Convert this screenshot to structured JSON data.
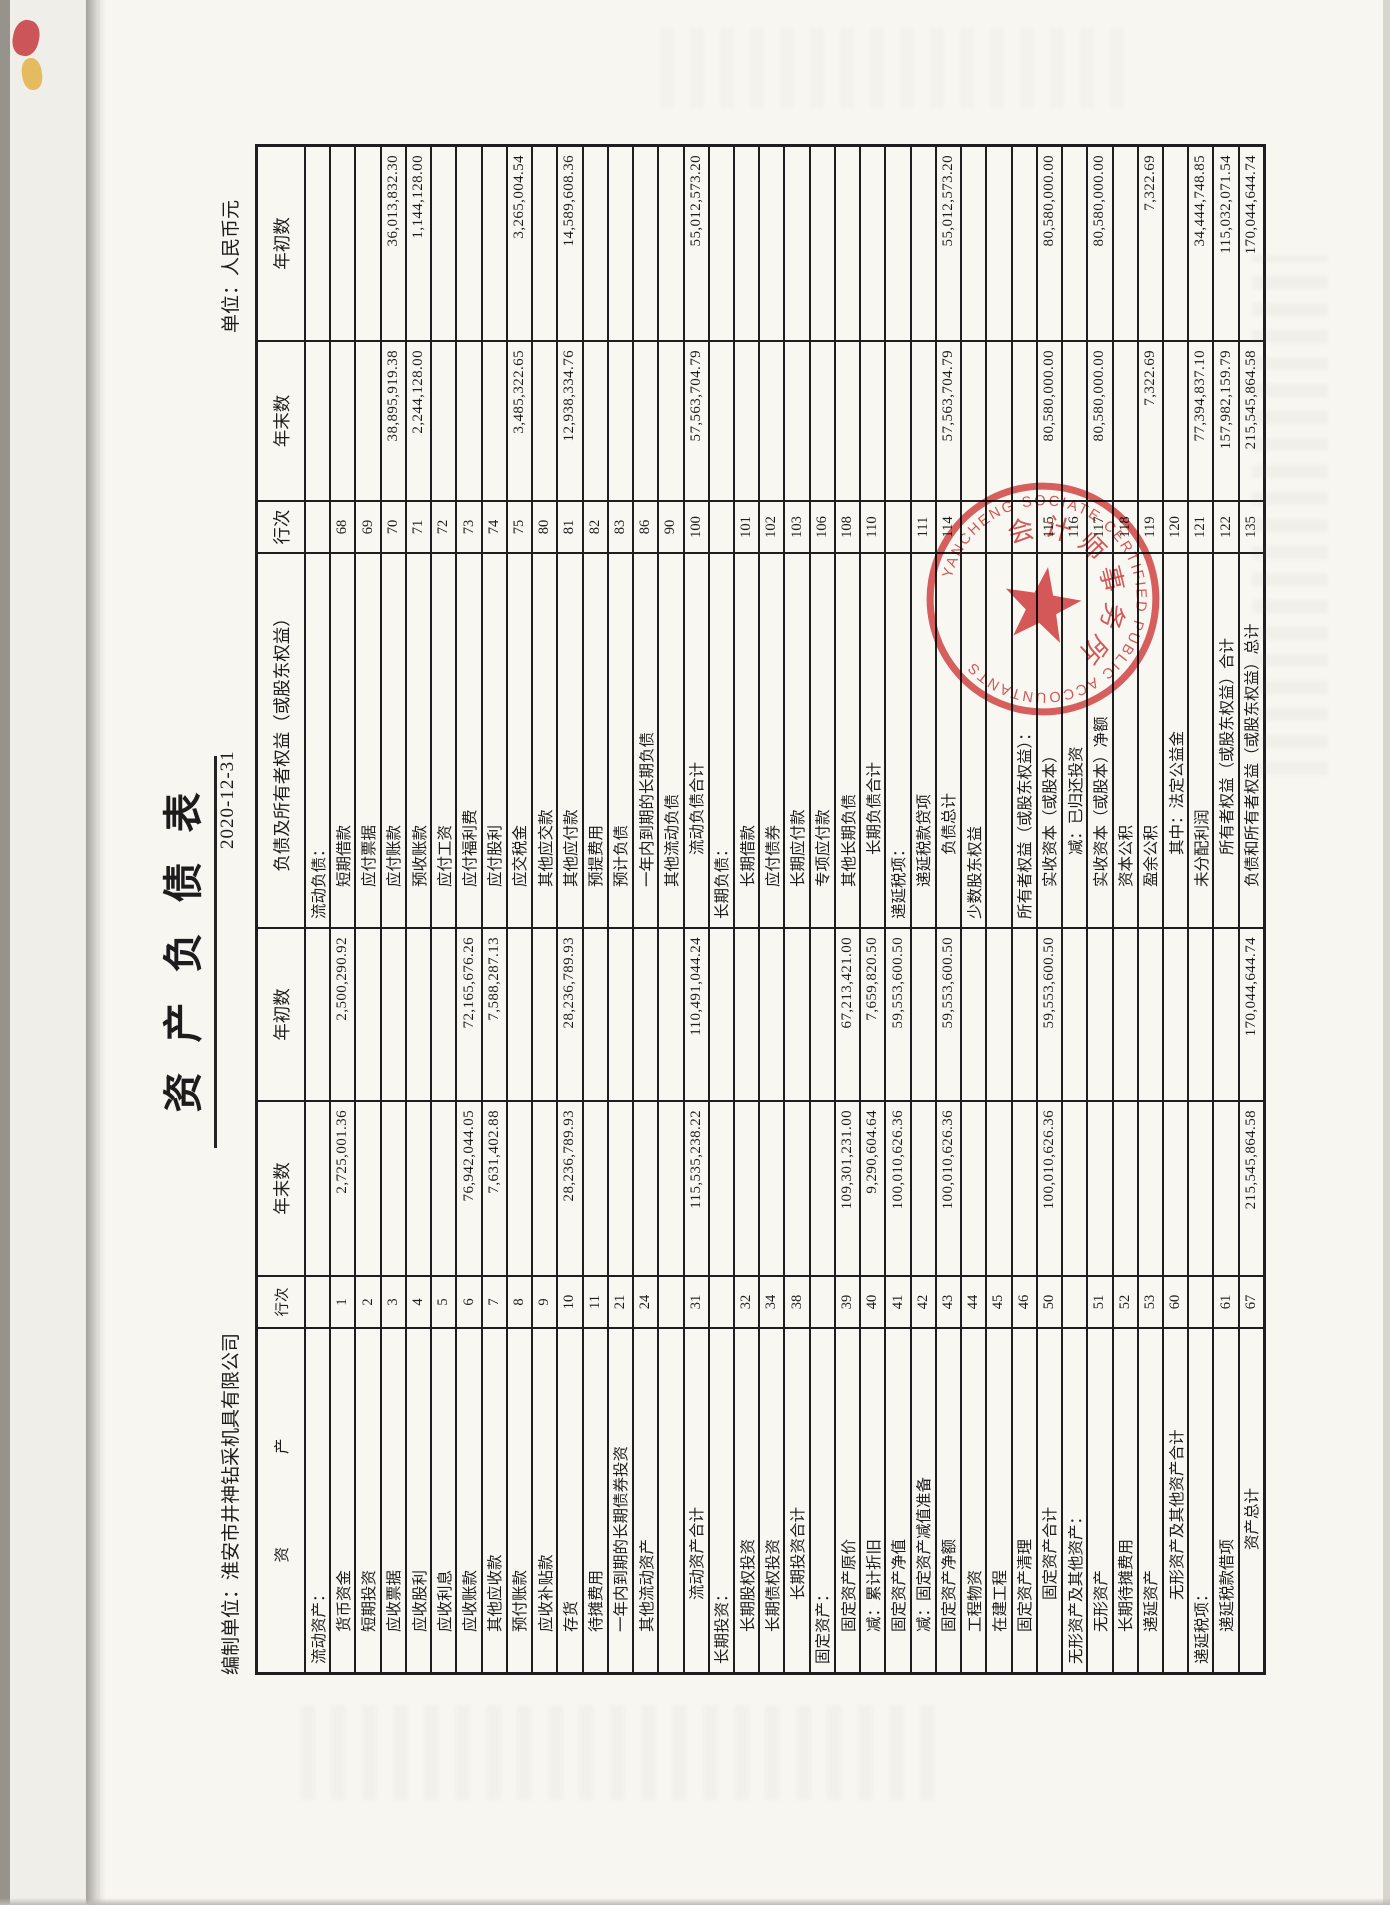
{
  "meta": {
    "title": "资产负债表",
    "prepared_by_label": "编制单位：",
    "company": "淮安市井神钻采机具有限公司",
    "date": "2020-12-31",
    "unit": "单位：人民币元"
  },
  "table": {
    "headers": {
      "asset": "资　　　　　　产",
      "line_no": "行次",
      "year_end": "年末数",
      "year_begin": "年初数",
      "liability": "负债及所有者权益（或股东权益）"
    },
    "rows": [
      {
        "a": "流动资产：",
        "ai": 0,
        "an": "",
        "ae": "",
        "ab": "",
        "l": "流动负债：",
        "li": 0,
        "ln": "",
        "le": "",
        "lb": ""
      },
      {
        "a": "货币资金",
        "ai": 1,
        "an": "1",
        "ae": "2,725,001.36",
        "ab": "2,500,290.92",
        "l": "短期借款",
        "li": 1,
        "ln": "68",
        "le": "",
        "lb": ""
      },
      {
        "a": "短期投资",
        "ai": 1,
        "an": "2",
        "ae": "",
        "ab": "",
        "l": "应付票据",
        "li": 1,
        "ln": "69",
        "le": "",
        "lb": ""
      },
      {
        "a": "应收票据",
        "ai": 1,
        "an": "3",
        "ae": "",
        "ab": "",
        "l": "应付账款",
        "li": 1,
        "ln": "70",
        "le": "38,895,919.38",
        "lb": "36,013,832.30"
      },
      {
        "a": "应收股利",
        "ai": 1,
        "an": "4",
        "ae": "",
        "ab": "",
        "l": "预收账款",
        "li": 1,
        "ln": "71",
        "le": "2,244,128.00",
        "lb": "1,144,128.00"
      },
      {
        "a": "应收利息",
        "ai": 1,
        "an": "5",
        "ae": "",
        "ab": "",
        "l": "应付工资",
        "li": 1,
        "ln": "72",
        "le": "",
        "lb": ""
      },
      {
        "a": "应收账款",
        "ai": 1,
        "an": "6",
        "ae": "76,942,044.05",
        "ab": "72,165,676.26",
        "l": "应付福利费",
        "li": 1,
        "ln": "73",
        "le": "",
        "lb": ""
      },
      {
        "a": "其他应收款",
        "ai": 1,
        "an": "7",
        "ae": "7,631,402.88",
        "ab": "7,588,287.13",
        "l": "应付股利",
        "li": 1,
        "ln": "74",
        "le": "",
        "lb": ""
      },
      {
        "a": "预付账款",
        "ai": 1,
        "an": "8",
        "ae": "",
        "ab": "",
        "l": "应交税金",
        "li": 1,
        "ln": "75",
        "le": "3,485,322.65",
        "lb": "3,265,004.54"
      },
      {
        "a": "应收补贴款",
        "ai": 1,
        "an": "9",
        "ae": "",
        "ab": "",
        "l": "其他应交款",
        "li": 1,
        "ln": "80",
        "le": "",
        "lb": ""
      },
      {
        "a": "存货",
        "ai": 1,
        "an": "10",
        "ae": "28,236,789.93",
        "ab": "28,236,789.93",
        "l": "其他应付款",
        "li": 1,
        "ln": "81",
        "le": "12,938,334.76",
        "lb": "14,589,608.36"
      },
      {
        "a": "待摊费用",
        "ai": 1,
        "an": "11",
        "ae": "",
        "ab": "",
        "l": "预提费用",
        "li": 1,
        "ln": "82",
        "le": "",
        "lb": ""
      },
      {
        "a": "一年内到期的长期债券投资",
        "ai": 1,
        "an": "21",
        "ae": "",
        "ab": "",
        "l": "预计负债",
        "li": 1,
        "ln": "83",
        "le": "",
        "lb": ""
      },
      {
        "a": "其他流动资产",
        "ai": 1,
        "an": "24",
        "ae": "",
        "ab": "",
        "l": "一年内到期的长期负债",
        "li": 1,
        "ln": "86",
        "le": "",
        "lb": ""
      },
      {
        "a": "",
        "ai": 1,
        "an": "",
        "ae": "",
        "ab": "",
        "l": "其他流动负债",
        "li": 1,
        "ln": "90",
        "le": "",
        "lb": ""
      },
      {
        "a": "流动资产合计",
        "ai": 2,
        "an": "31",
        "ae": "115,535,238.22",
        "ab": "110,491,044.24",
        "l": "流动负债合计",
        "li": 2,
        "ln": "100",
        "le": "57,563,704.79",
        "lb": "55,012,573.20"
      },
      {
        "a": "长期投资：",
        "ai": 0,
        "an": "",
        "ae": "",
        "ab": "",
        "l": "长期负债：",
        "li": 0,
        "ln": "",
        "le": "",
        "lb": ""
      },
      {
        "a": "长期股权投资",
        "ai": 1,
        "an": "32",
        "ae": "",
        "ab": "",
        "l": "长期借款",
        "li": 1,
        "ln": "101",
        "le": "",
        "lb": ""
      },
      {
        "a": "长期债权投资",
        "ai": 1,
        "an": "34",
        "ae": "",
        "ab": "",
        "l": "应付债券",
        "li": 1,
        "ln": "102",
        "le": "",
        "lb": ""
      },
      {
        "a": "长期投资合计",
        "ai": 2,
        "an": "38",
        "ae": "",
        "ab": "",
        "l": "长期应付款",
        "li": 1,
        "ln": "103",
        "le": "",
        "lb": ""
      },
      {
        "a": "固定资产：",
        "ai": 0,
        "an": "",
        "ae": "",
        "ab": "",
        "l": "专项应付款",
        "li": 1,
        "ln": "106",
        "le": "",
        "lb": ""
      },
      {
        "a": "固定资产原价",
        "ai": 1,
        "an": "39",
        "ae": "109,301,231.00",
        "ab": "67,213,421.00",
        "l": "其他长期负债",
        "li": 1,
        "ln": "108",
        "le": "",
        "lb": ""
      },
      {
        "a": "减：累计折旧",
        "ai": 1,
        "an": "40",
        "ae": "9,290,604.64",
        "ab": "7,659,820.50",
        "l": "长期负债合计",
        "li": 2,
        "ln": "110",
        "le": "",
        "lb": ""
      },
      {
        "a": "固定资产净值",
        "ai": 1,
        "an": "41",
        "ae": "100,010,626.36",
        "ab": "59,553,600.50",
        "l": "递延税项：",
        "li": 0,
        "ln": "",
        "le": "",
        "lb": ""
      },
      {
        "a": "减：固定资产减值准备",
        "ai": 1,
        "an": "42",
        "ae": "",
        "ab": "",
        "l": "递延税款贷项",
        "li": 1,
        "ln": "111",
        "le": "",
        "lb": ""
      },
      {
        "a": "固定资产净额",
        "ai": 1,
        "an": "43",
        "ae": "100,010,626.36",
        "ab": "59,553,600.50",
        "l": "负债总计",
        "li": 2,
        "ln": "114",
        "le": "57,563,704.79",
        "lb": "55,012,573.20"
      },
      {
        "a": "工程物资",
        "ai": 1,
        "an": "44",
        "ae": "",
        "ab": "",
        "l": "少数股东权益",
        "li": 0,
        "ln": "",
        "le": "",
        "lb": ""
      },
      {
        "a": "在建工程",
        "ai": 1,
        "an": "45",
        "ae": "",
        "ab": "",
        "l": "",
        "li": 1,
        "ln": "",
        "le": "",
        "lb": ""
      },
      {
        "a": "固定资产清理",
        "ai": 1,
        "an": "46",
        "ae": "",
        "ab": "",
        "l": "所有者权益（或股东权益）：",
        "li": 0,
        "ln": "",
        "le": "",
        "lb": ""
      },
      {
        "a": "固定资产合计",
        "ai": 2,
        "an": "50",
        "ae": "100,010,626.36",
        "ab": "59,553,600.50",
        "l": "实收资本（或股本）",
        "li": 1,
        "ln": "115",
        "le": "80,580,000.00",
        "lb": "80,580,000.00"
      },
      {
        "a": "无形资产及其他资产：",
        "ai": 0,
        "an": "",
        "ae": "",
        "ab": "",
        "l": "减：已归还投资",
        "li": 2,
        "ln": "116",
        "le": "",
        "lb": ""
      },
      {
        "a": "无形资产",
        "ai": 1,
        "an": "51",
        "ae": "",
        "ab": "",
        "l": "实收资本（或股本）净额",
        "li": 1,
        "ln": "117",
        "le": "80,580,000.00",
        "lb": "80,580,000.00"
      },
      {
        "a": "长期待摊费用",
        "ai": 1,
        "an": "52",
        "ae": "",
        "ab": "",
        "l": "资本公积",
        "li": 1,
        "ln": "118",
        "le": "",
        "lb": ""
      },
      {
        "a": "递延资产",
        "ai": 1,
        "an": "53",
        "ae": "",
        "ab": "",
        "l": "盈余公积",
        "li": 1,
        "ln": "119",
        "le": "7,322.69",
        "lb": "7,322.69"
      },
      {
        "a": "无形资产及其他资产合计",
        "ai": 2,
        "an": "60",
        "ae": "",
        "ab": "",
        "l": "其中：法定公益金",
        "li": 2,
        "ln": "120",
        "le": "",
        "lb": ""
      },
      {
        "a": "递延税项：",
        "ai": 0,
        "an": "",
        "ae": "",
        "ab": "",
        "l": "未分配利润",
        "li": 1,
        "ln": "121",
        "le": "77,394,837.10",
        "lb": "34,444,748.85"
      },
      {
        "a": "递延税款借项",
        "ai": 1,
        "an": "61",
        "ae": "",
        "ab": "",
        "l": "所有者权益（或股东权益）合计",
        "li": 2,
        "ln": "122",
        "le": "157,982,159.79",
        "lb": "115,032,071.54"
      },
      {
        "a": "资产总计",
        "ai": 3,
        "an": "67",
        "ae": "215,545,864.58",
        "ab": "170,044,644.74",
        "l": "负债和所有者权益（或股东权益）总计",
        "li": 1,
        "ln": "135",
        "le": "215,545,864.58",
        "lb": "170,044,644.74"
      }
    ]
  },
  "stamp": {
    "english_arc": "YANCHENG SOCIATE CERTIFIED PUBLIC ACCOUNTANTS",
    "chinese_arc": "会计师事务所",
    "color": "#cf2e2e"
  }
}
